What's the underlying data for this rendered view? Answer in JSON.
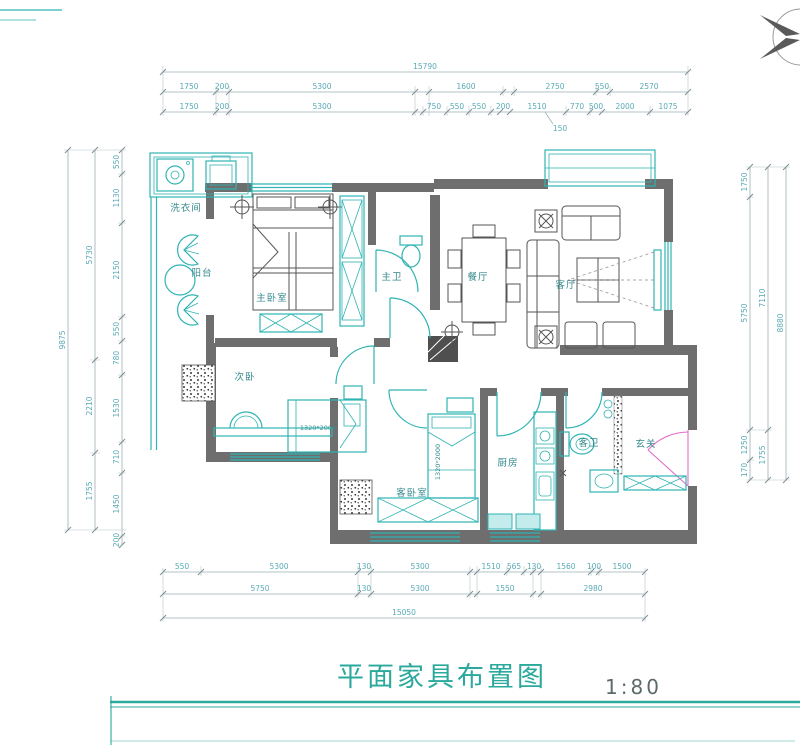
{
  "meta": {
    "title": "平面家具布置图",
    "scale": "1:80"
  },
  "rooms": {
    "laundry": "洗衣间",
    "balcony": "阳台",
    "master_bedroom": "主卧室",
    "master_bath": "主卫",
    "dining": "餐厅",
    "living": "客厅",
    "second_bedroom": "次卧",
    "guest_bedroom": "客卧室",
    "kitchen": "厨房",
    "guest_bath": "客卫",
    "entry": "玄关"
  },
  "furniture_labels": {
    "bed_second": "1320*2000",
    "bed_guest": "1320*2000"
  },
  "dims": {
    "top_total": "15790",
    "top_row2": [
      "1750",
      "200",
      "5300",
      "1600",
      "2750",
      "550",
      "2570"
    ],
    "top_row3": [
      "1750",
      "200",
      "5300",
      "750",
      "550",
      "550",
      "200",
      "1510",
      "770",
      "500",
      "2000",
      "1075"
    ],
    "top_leader": "150",
    "left_outer": "9875",
    "left_mid": [
      "5730",
      "2210",
      "1755"
    ],
    "left_inner": [
      "550",
      "1130",
      "2150",
      "550",
      "780",
      "1530",
      "710",
      "1450",
      "200"
    ],
    "right_outer": "8880",
    "right_mid": [
      "7110",
      "1755"
    ],
    "right_inner": [
      "1750",
      "5750",
      "1250",
      "170"
    ],
    "bottom_row1": [
      "550",
      "5300",
      "130",
      "5300",
      "1510",
      "565",
      "130",
      "1560",
      "100",
      "1500"
    ],
    "bottom_row2": [
      "5750",
      "130",
      "5300",
      "1550",
      "2980"
    ],
    "bottom_total": "15050"
  },
  "colors": {
    "teal": "#2fb3b3",
    "wall": "#6e6e6e",
    "dim_text": "#58aab6",
    "door_accent": "#e36bc8",
    "title": "#2aa99c"
  }
}
